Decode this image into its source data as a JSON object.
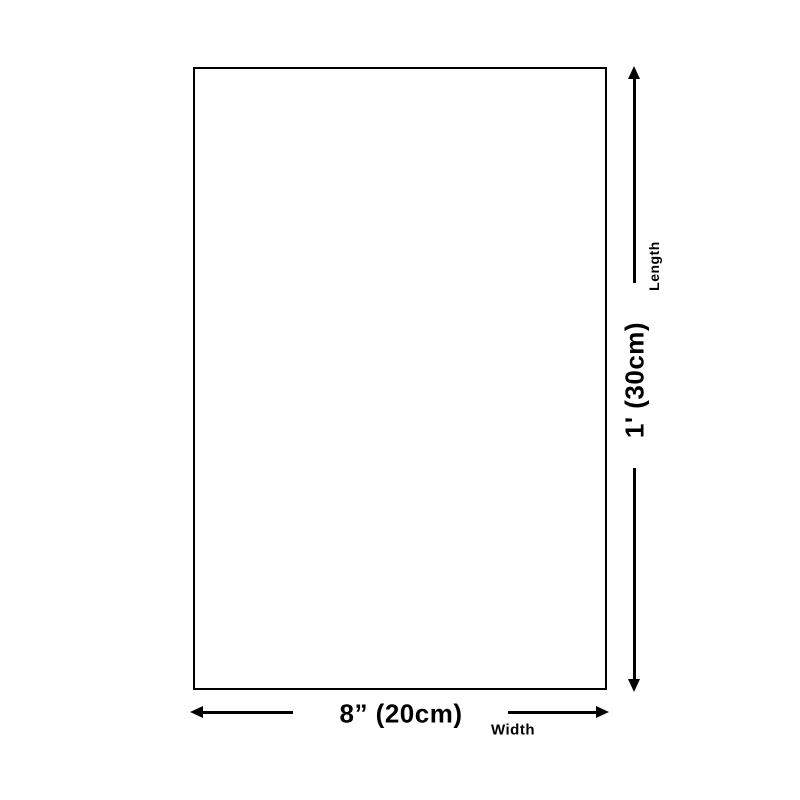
{
  "diagram": {
    "length": {
      "value": "1' (30cm)",
      "label": "Length"
    },
    "width": {
      "value": "8” (20cm)",
      "label": "Width"
    },
    "colors": {
      "line": "#000000",
      "background": "#ffffff"
    }
  }
}
